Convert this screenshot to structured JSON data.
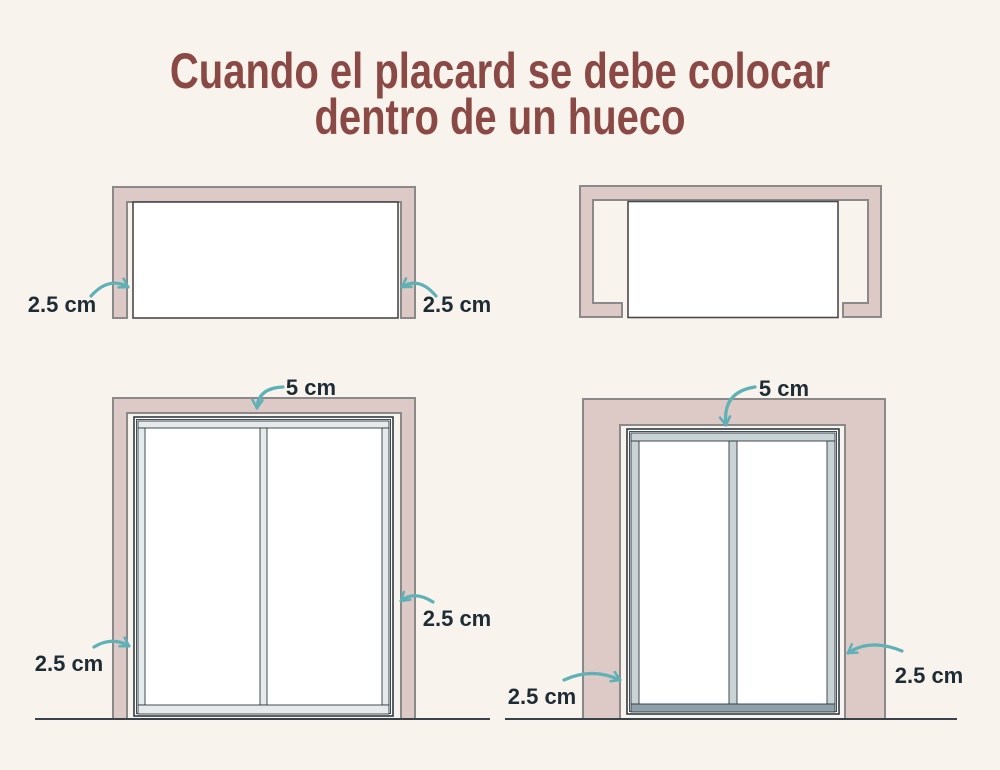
{
  "title": {
    "line1": "Cuando el placard se debe colocar",
    "line2": "dentro de un hueco"
  },
  "colors": {
    "background": "#f8f3ec",
    "title_text": "#8a4945",
    "wall_fill": "#ddc9c6",
    "wall_stroke": "#8a8a8a",
    "arrow_accent": "#5fb1b6",
    "label_text": "#1e2c35",
    "outline_dark": "#2e3b42"
  },
  "diagrams": {
    "top_left": {
      "labels": {
        "left": "2.5 cm",
        "right": "2.5 cm"
      }
    },
    "top_right": {
      "labels": {}
    },
    "bottom_left": {
      "labels": {
        "top": "5 cm",
        "right": "2.5 cm",
        "bottom_left": "2.5 cm"
      }
    },
    "bottom_right": {
      "labels": {
        "top": "5 cm",
        "right": "2.5 cm",
        "bottom_left": "2.5 cm"
      }
    }
  }
}
